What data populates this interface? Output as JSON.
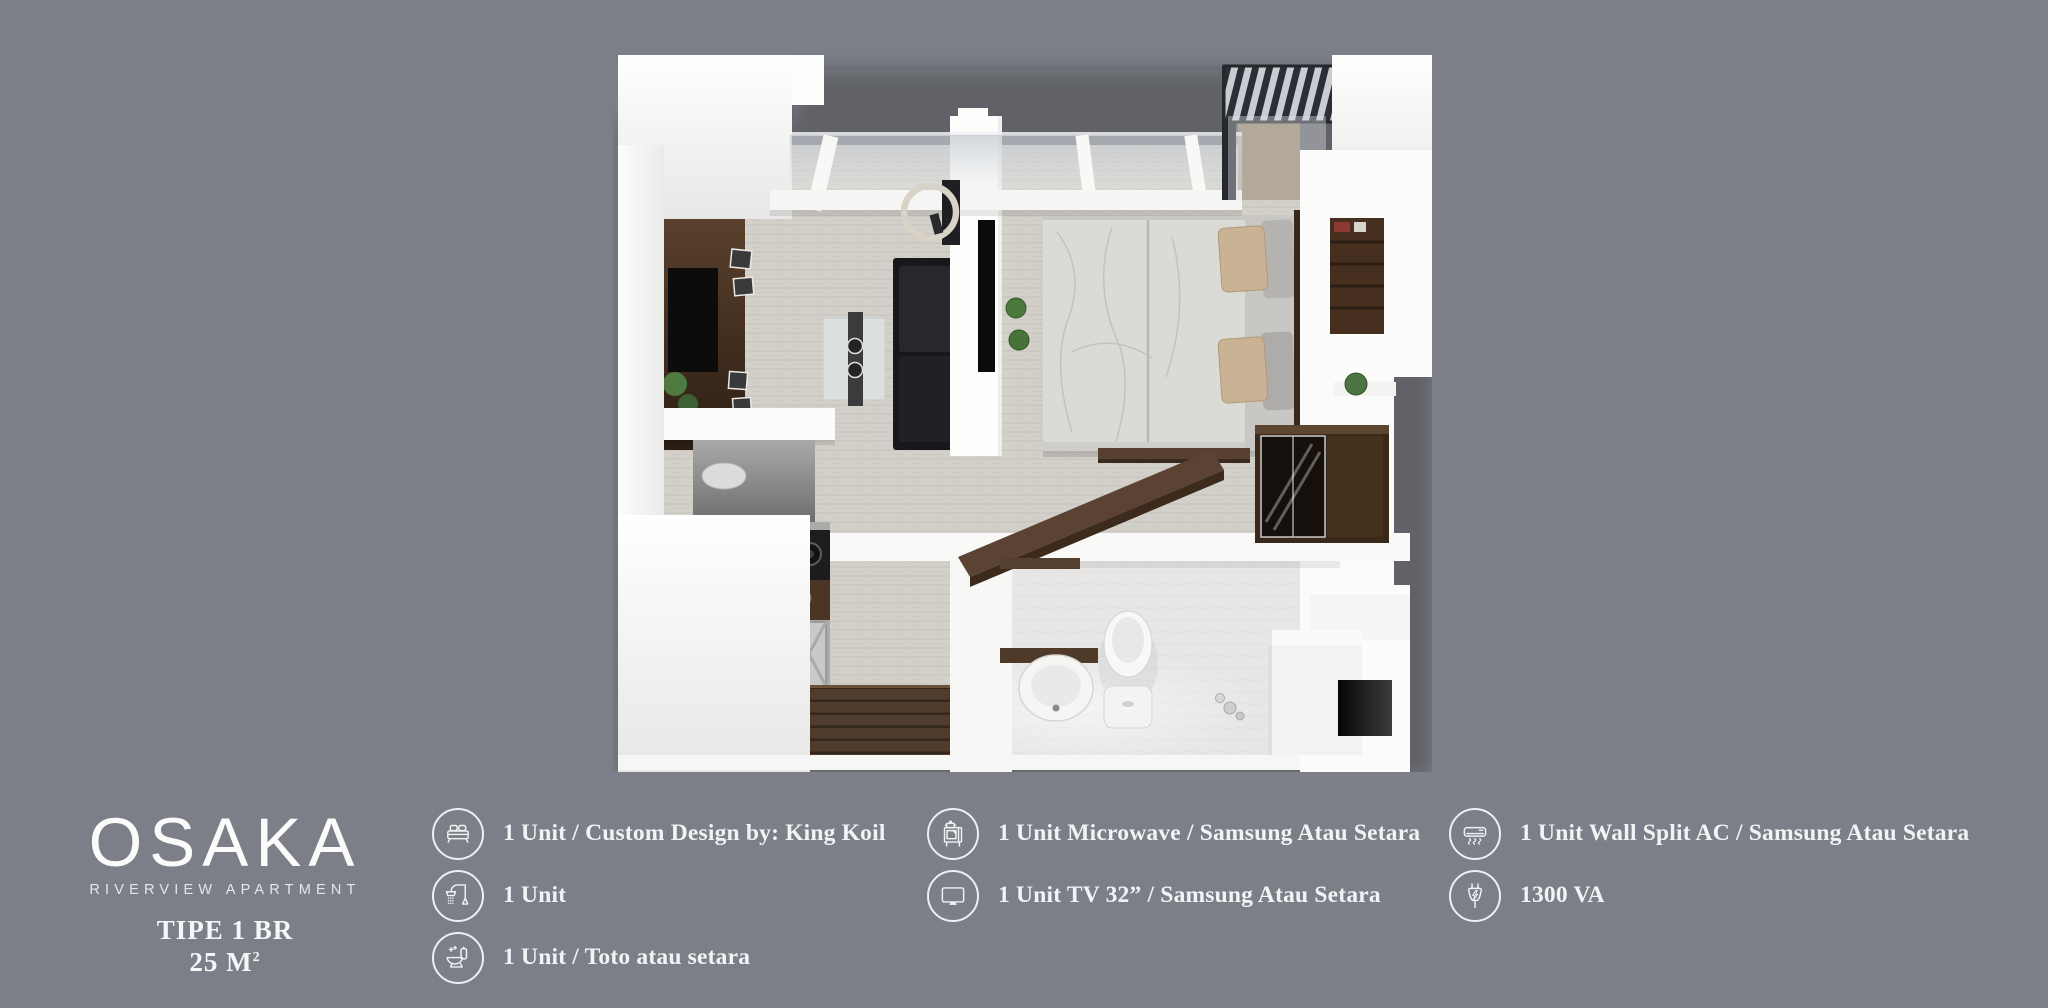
{
  "background_color": "#7c7f87",
  "text_color": "#f2f3f5",
  "logo": {
    "name": "OSAKA",
    "subtitle": "RIVERVIEW APARTMENT",
    "type_label": "TIPE 1 BR",
    "size_label": "25 M",
    "size_superscript": "2"
  },
  "legend": {
    "columns": [
      {
        "items": [
          {
            "icon": "bed-icon",
            "label": "1 Unit / Custom Design by: King Koil"
          },
          {
            "icon": "shower-icon",
            "label": "1 Unit"
          },
          {
            "icon": "toilet-icon",
            "label": "1 Unit / Toto atau setara"
          }
        ]
      },
      {
        "items": [
          {
            "icon": "microwave-icon",
            "label": "1 Unit Microwave / Samsung Atau Setara"
          },
          {
            "icon": "tv-icon",
            "label": "1 Unit TV 32” / Samsung Atau Setara"
          }
        ]
      },
      {
        "items": [
          {
            "icon": "ac-icon",
            "label": "1 Unit Wall Split AC / Samsung Atau Setara"
          },
          {
            "icon": "plug-icon",
            "label": "1300 VA"
          }
        ]
      }
    ]
  },
  "floor_plan": {
    "description": "3D top-down render of a 1-bedroom apartment unit with living area, bedroom, kitchen, bathroom and balcony"
  }
}
